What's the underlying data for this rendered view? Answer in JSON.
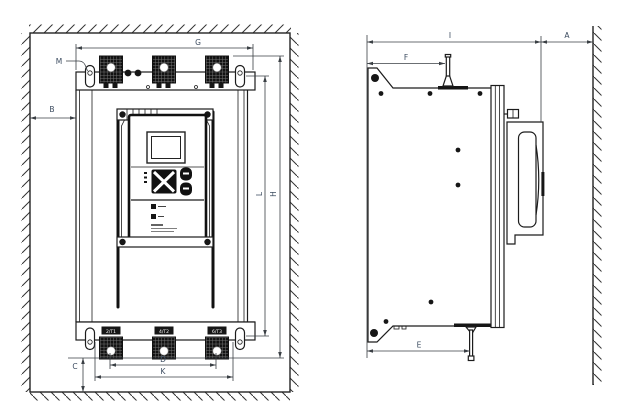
{
  "front_view": {
    "dims": {
      "G": "G",
      "M": "M",
      "B": "B",
      "C": "C",
      "D": "D",
      "K": "K",
      "L": "L",
      "H": "H"
    },
    "terminal_labels": [
      "2/T1",
      "4/T2",
      "6/T3"
    ]
  },
  "side_view": {
    "dims": {
      "I": "I",
      "A": "A",
      "F": "F",
      "E": "E"
    }
  },
  "colors": {
    "background": "#ffffff",
    "device_line": "#1c1c1c",
    "dimension_line": "#3a3f44",
    "dimension_label": "#3c4c60",
    "wall_line": "#232323",
    "terminal_fill": "#111111"
  }
}
